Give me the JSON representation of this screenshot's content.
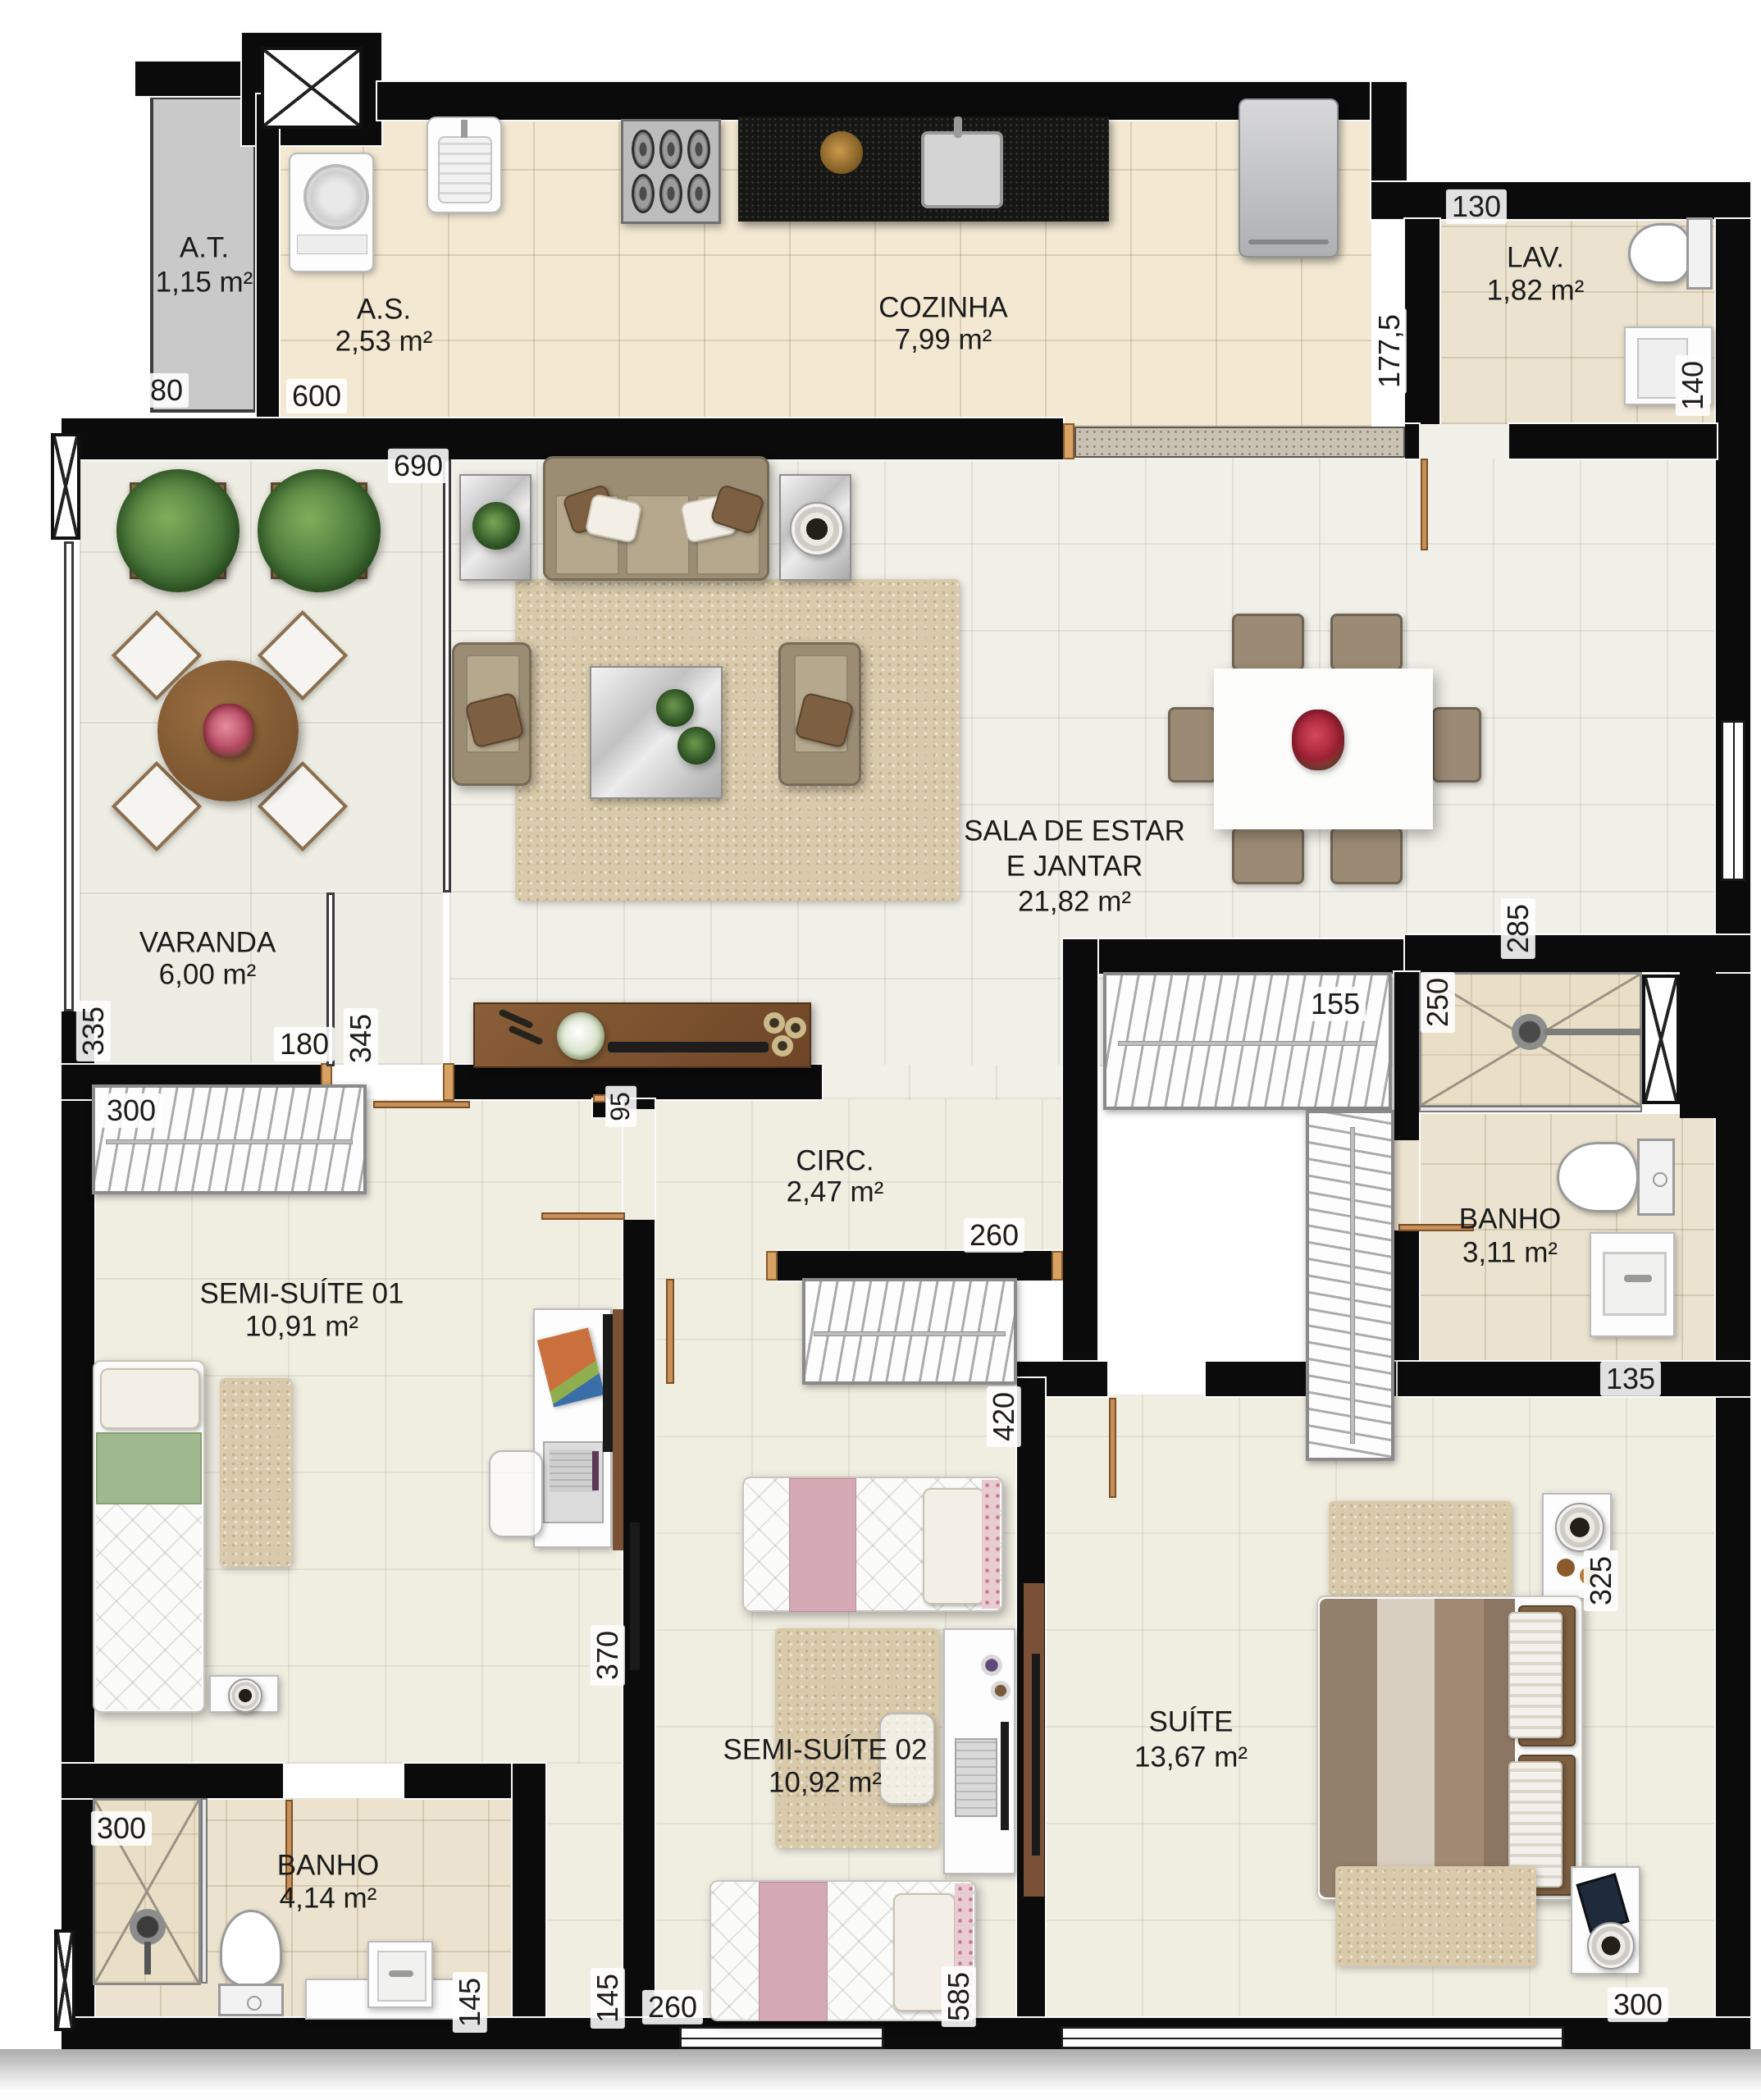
{
  "plan_title": "apartment floor plan",
  "palette": {
    "wall": "#0b0b0b",
    "kitchen_floor": "#f3e9d3",
    "living_floor": "#f1f0e8",
    "bath_floor": "#ebe3cf",
    "wood_door": "#c98f57",
    "sideboard_wood": "#7a5136",
    "counter_granite": "#161614"
  },
  "rooms": {
    "at": {
      "name": "A.T.",
      "area": "1,15 m²"
    },
    "as": {
      "name": "A.S.",
      "area": "2,53 m²"
    },
    "cozinha": {
      "name": "COZINHA",
      "area": "7,99 m²"
    },
    "lav": {
      "name": "LAV.",
      "area": "1,82 m²"
    },
    "varanda": {
      "name": "VARANDA",
      "area": "6,00 m²"
    },
    "sala": {
      "name_line1": "SALA DE ESTAR",
      "name_line2": "E JANTAR",
      "area": "21,82 m²"
    },
    "circ": {
      "name": "CIRC.",
      "area": "2,47 m²"
    },
    "semi_suite_01": {
      "name": "SEMI-SUÍTE 01",
      "area": "10,91 m²"
    },
    "banho_suites": {
      "name": "BANHO",
      "area": "3,11 m²"
    },
    "semi_suite_02": {
      "name": "SEMI-SUÍTE 02",
      "area": "10,92 m²"
    },
    "suite": {
      "name": "SUÍTE",
      "area": "13,67 m²"
    },
    "banho_social": {
      "name": "BANHO",
      "area": "4,14 m²"
    }
  },
  "dims": {
    "at_width": "80",
    "service_width": "600",
    "kitchen_depth": "177,5",
    "lav_width": "130",
    "lav_depth": "140",
    "sala_width": "690",
    "varanda_depth": "335",
    "varanda_door": "180",
    "aparador_wall": "345",
    "hall_wall": "95",
    "closet_semi1": "300",
    "sala_right": "285",
    "closet_suite": "155",
    "shower_suites": "250",
    "circ_door": "260",
    "closet_semi2": "420",
    "banho_suites_width": "135",
    "suite_side": "325",
    "semi1_depth": "370",
    "shower_social": "300",
    "banho_counter": "145",
    "vestibule": "145",
    "semi2_door": "260",
    "semi2_depth": "585",
    "suite_width": "300"
  }
}
